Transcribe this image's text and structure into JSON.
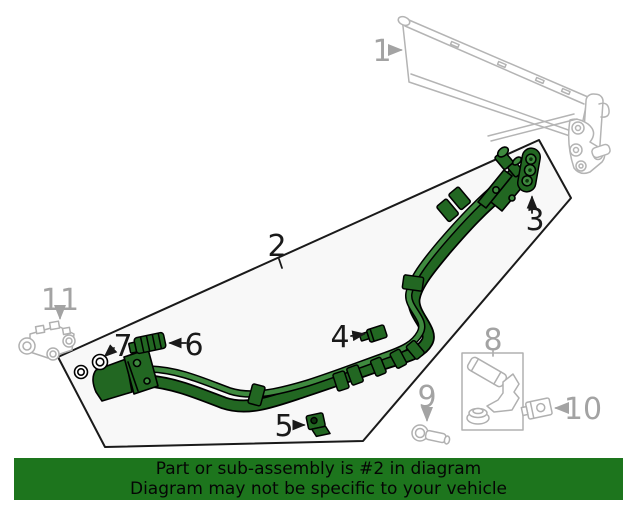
{
  "banner": {
    "line1": "Part or sub-assembly is #2 in diagram",
    "line2": "Diagram may not be specific to your vehicle"
  },
  "callouts": [
    {
      "num": "1",
      "tone": "muted"
    },
    {
      "num": "2",
      "tone": "strong"
    },
    {
      "num": "3",
      "tone": "strong"
    },
    {
      "num": "4",
      "tone": "strong"
    },
    {
      "num": "5",
      "tone": "strong"
    },
    {
      "num": "6",
      "tone": "strong"
    },
    {
      "num": "7",
      "tone": "strong"
    },
    {
      "num": "8",
      "tone": "muted"
    },
    {
      "num": "9",
      "tone": "muted"
    },
    {
      "num": "10",
      "tone": "muted"
    },
    {
      "num": "11",
      "tone": "muted"
    }
  ],
  "colors": {
    "highlight_green": "#226722",
    "highlight_light_green": "#3f8a3f",
    "muted_line_gray": "#b4b4b4",
    "muted_label_gray": "#a3a3a3",
    "strong_label": "#1a1a1a",
    "highlight_region_fill": "#f8f8f8",
    "banner_bg": "#1d751d",
    "banner_text": "#050505"
  }
}
